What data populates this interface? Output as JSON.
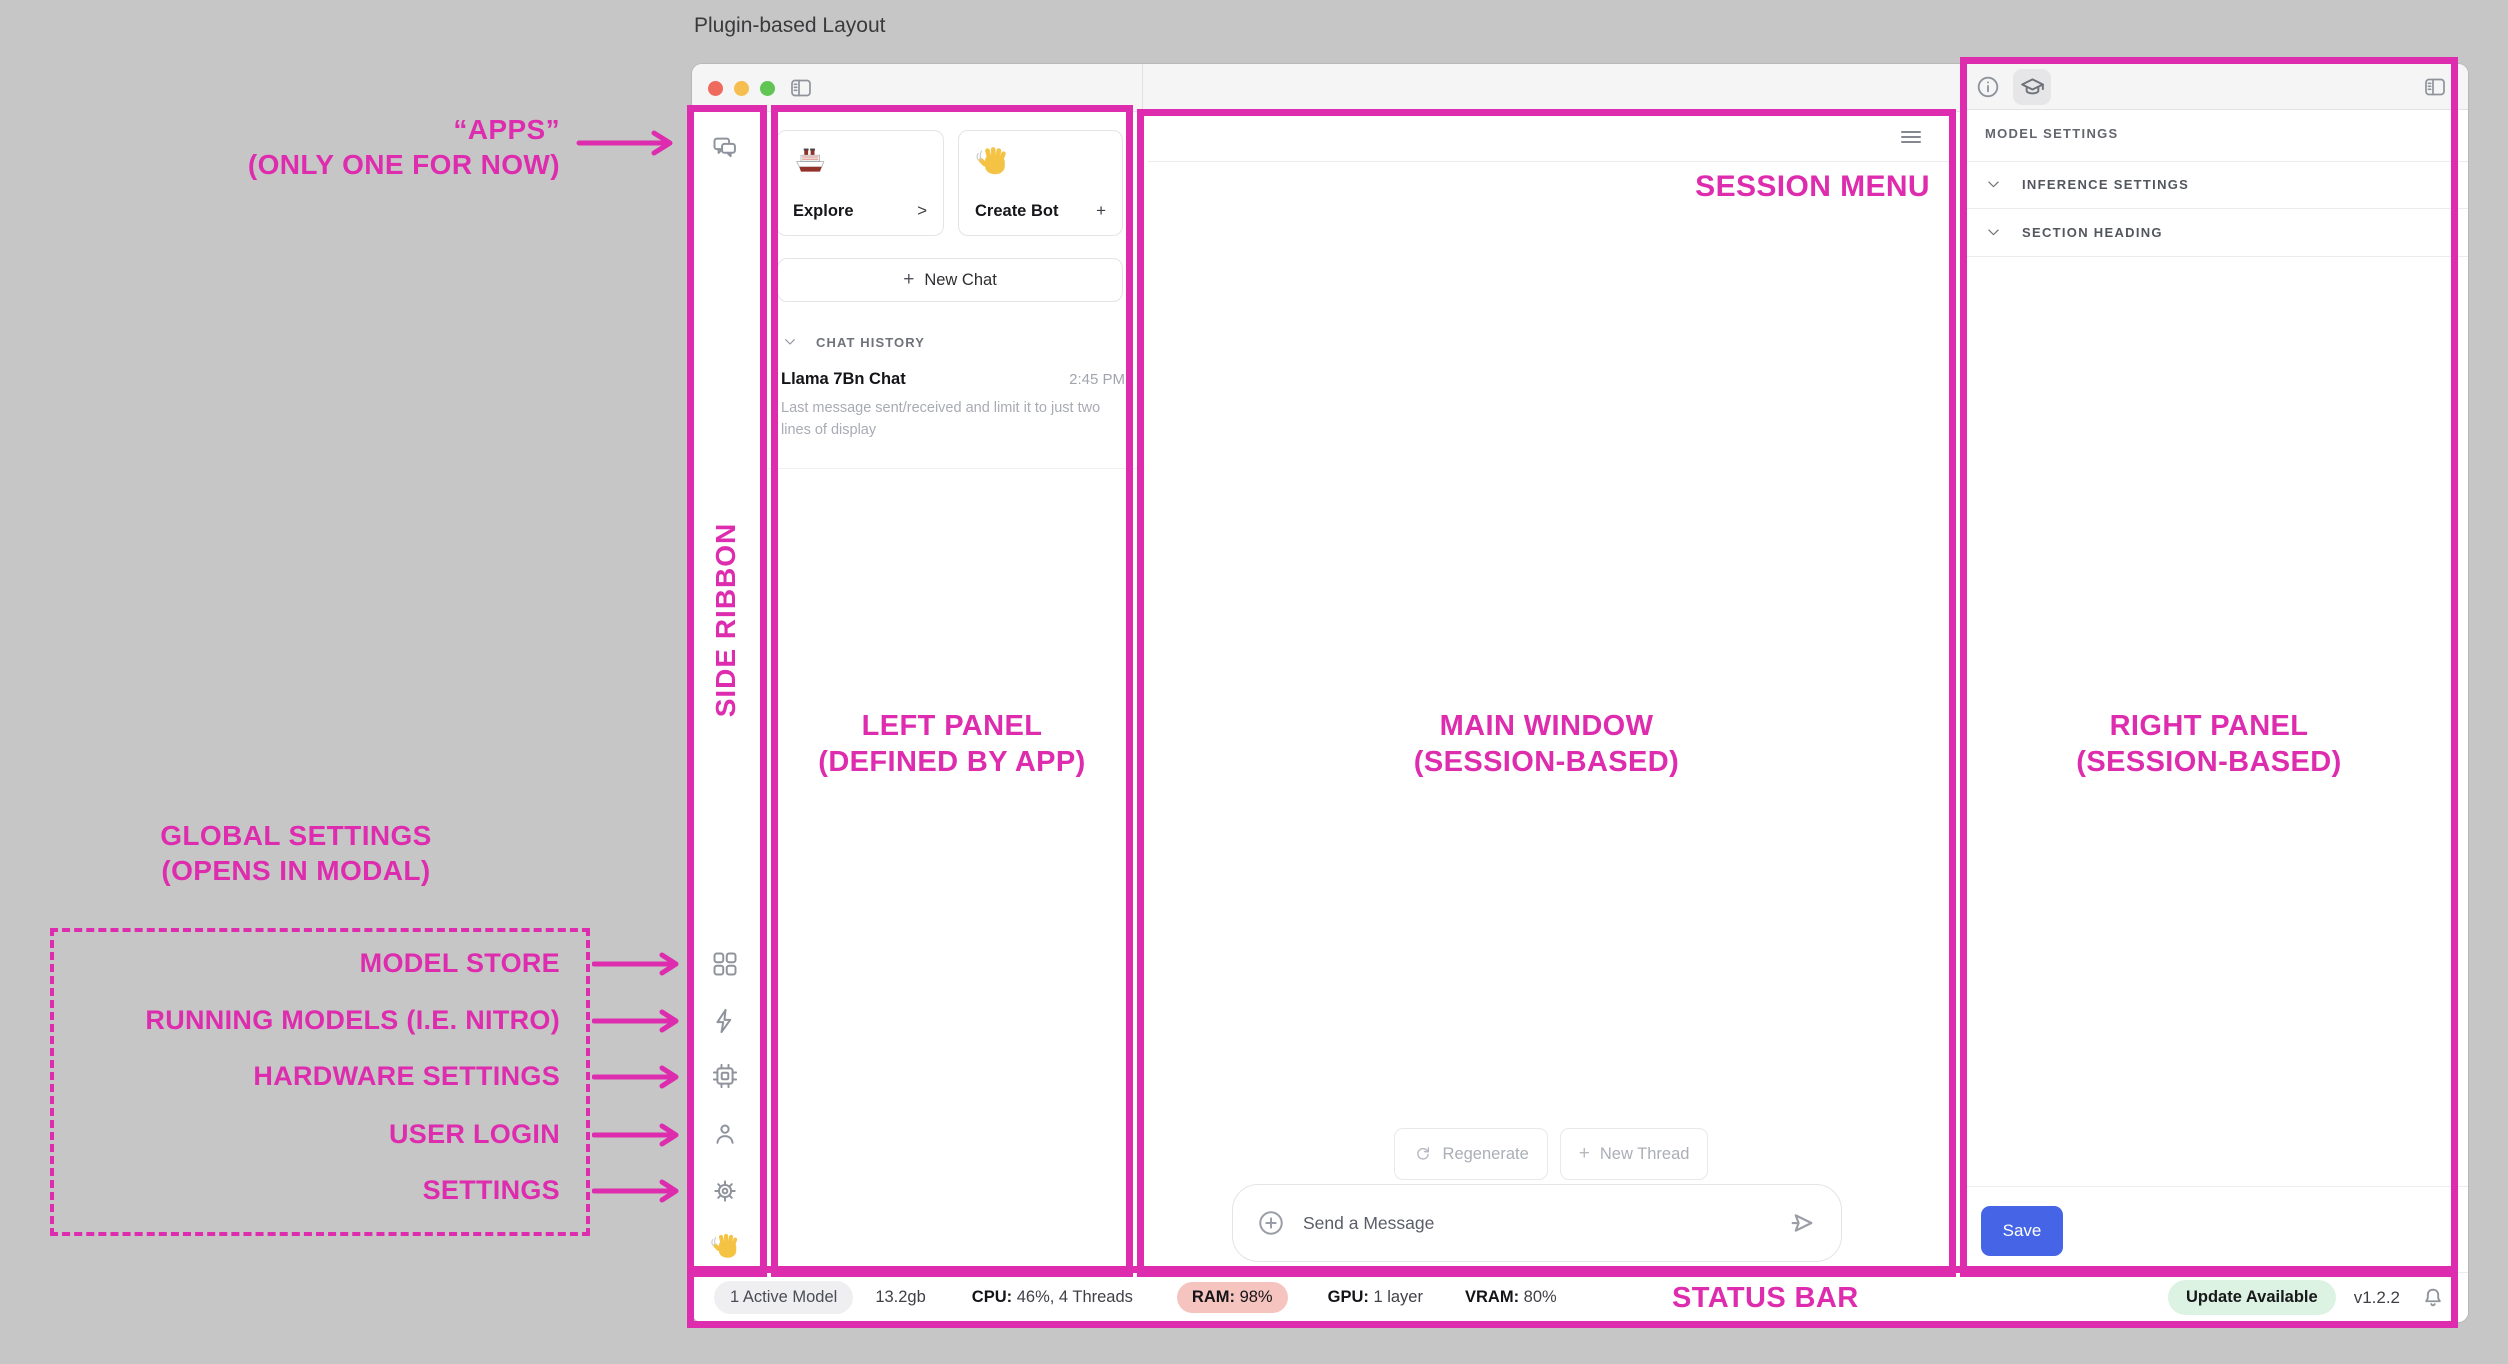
{
  "app": {
    "title": "Plugin-based Layout"
  },
  "colors": {
    "annotation_magenta": "#DE2CAE",
    "save_button_blue": "#4565E6",
    "ram_pill_bg": "#F6C4BF",
    "update_pill_bg": "#DCF2E3",
    "active_model_pill_bg": "#EFEFF1",
    "traffic_red": "#EE6A5F",
    "traffic_yellow": "#F5BE4F",
    "traffic_green": "#61C554"
  },
  "icons": {
    "plus": "+",
    "chat-bubbles": "side ribbon app icon",
    "grid": "model store",
    "bolt": "running models",
    "chip": "hardware settings",
    "person": "user login",
    "gear": "settings",
    "wave-emoji": "👋",
    "ship-emoji": "🚢",
    "hamburger": "session menu",
    "sidebar-toggle": "panel toggle",
    "info": "info tab",
    "graduation-cap": "assistant tab",
    "circle-plus": "attach",
    "send": "send message",
    "refresh": "regenerate",
    "bell": "notifications",
    "chevron-down": "collapse"
  },
  "annotations": {
    "apps": {
      "line1": "“APPS”",
      "line2": "(ONLY ONE FOR NOW)"
    },
    "side_ribbon": "SIDE RIBBON",
    "left_panel": {
      "line1": "LEFT PANEL",
      "line2": "(DEFINED BY APP)"
    },
    "main_window": {
      "line1": "MAIN WINDOW",
      "line2": "(SESSION-BASED)"
    },
    "right_panel": {
      "line1": "RIGHT PANEL",
      "line2": "(SESSION-BASED)"
    },
    "session_menu": "SESSION MENU",
    "status_bar": "STATUS BAR",
    "global_settings": {
      "line1": "GLOBAL SETTINGS",
      "line2": "(OPENS IN MODAL)"
    },
    "ribbon_targets": [
      "MODEL STORE",
      "RUNNING MODELS (I.E. NITRO)",
      "HARDWARE SETTINGS",
      "USER LOGIN",
      "SETTINGS"
    ]
  },
  "left_panel": {
    "cards": [
      {
        "emoji": "ship",
        "label": "Explore",
        "action": ">"
      },
      {
        "emoji": "wave",
        "label": "Create Bot",
        "action": "+"
      }
    ],
    "new_chat_label": "New Chat",
    "history_header": "CHAT HISTORY",
    "chats": [
      {
        "title": "Llama 7Bn Chat",
        "time": "2:45 PM",
        "preview": "Last message sent/received and limit it to just two lines of display"
      }
    ]
  },
  "main": {
    "regenerate_label": "Regenerate",
    "new_thread_label": "New Thread",
    "input_placeholder": "Send a Message"
  },
  "right_panel": {
    "section_title": "MODEL SETTINGS",
    "rows": [
      "INFERENCE SETTINGS",
      "SECTION HEADING"
    ],
    "save_label": "Save"
  },
  "status": {
    "active_model": "1 Active Model",
    "size": "13.2gb",
    "cpu_label": "CPU:",
    "cpu_value": "46%, 4 Threads",
    "ram_label": "RAM:",
    "ram_value": "98%",
    "gpu_label": "GPU:",
    "gpu_value": "1 layer",
    "vram_label": "VRAM:",
    "vram_value": "80%",
    "update_badge": "Update Available",
    "version": "v1.2.2"
  }
}
